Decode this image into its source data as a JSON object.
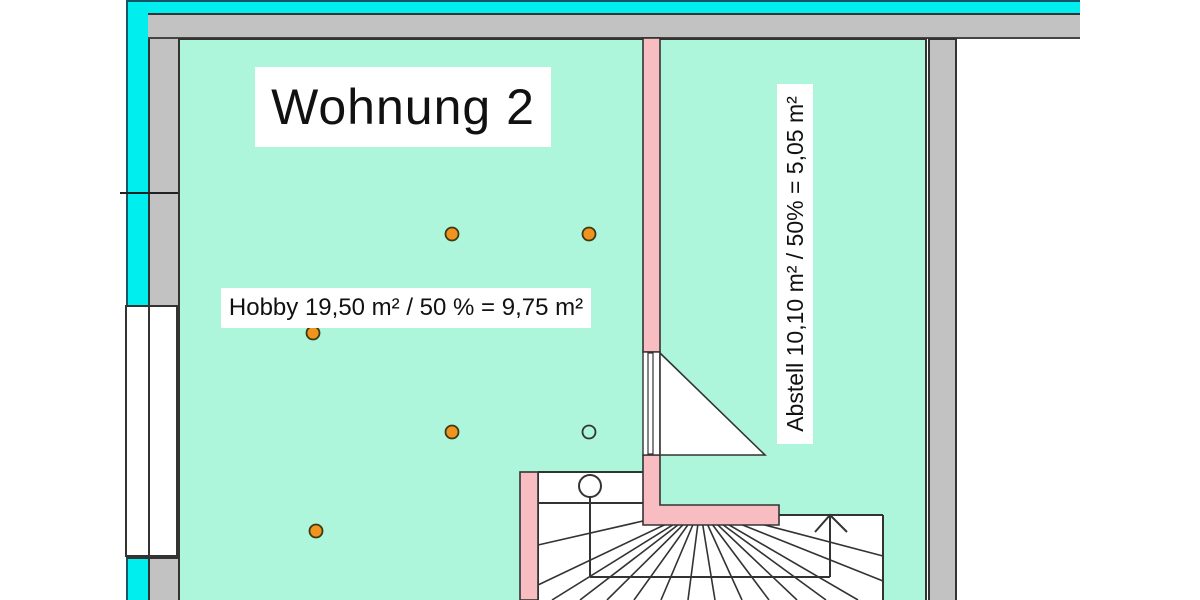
{
  "plan": {
    "apartment_title": "Wohnung 2",
    "hobby_label": "Hobby 19,50 m² / 50 % = 9,75 m²",
    "abstell_label": "Abstell 10,10 m² / 50% = 5,05 m²"
  },
  "colors": {
    "highlight_cyan": "#00EEEE",
    "wall_gray": "#C2C2C2",
    "floor_mint": "#ADF6DB",
    "wall_pink": "#F7BDC1",
    "marker_orange": "#F0941F",
    "line_dark": "#2B2B2B"
  },
  "markers": {
    "filled_round_markers": 5,
    "hollow_round_markers": 1
  }
}
